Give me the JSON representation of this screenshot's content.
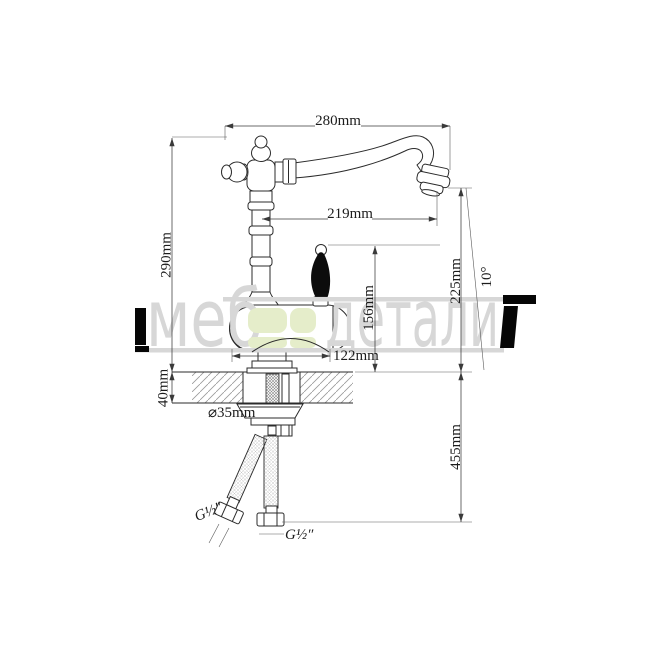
{
  "watermark": {
    "part1": "меб",
    "part2": "детали",
    "colors": {
      "gray": "#d7d7d7",
      "green": "#e5edca",
      "black": "#060606"
    }
  },
  "dimensions": {
    "overall_width": "280mm",
    "spout_reach": "219mm",
    "overall_height": "290mm",
    "outlet_height": "225mm",
    "outlet_angle": "10°",
    "handle_height": "156mm",
    "base_width": "122mm",
    "deck_thickness": "40mm",
    "hole_diameter": "⌀35mm",
    "hose_drop": "455mm",
    "thread_left": "G½″",
    "thread_right": "G½″"
  }
}
